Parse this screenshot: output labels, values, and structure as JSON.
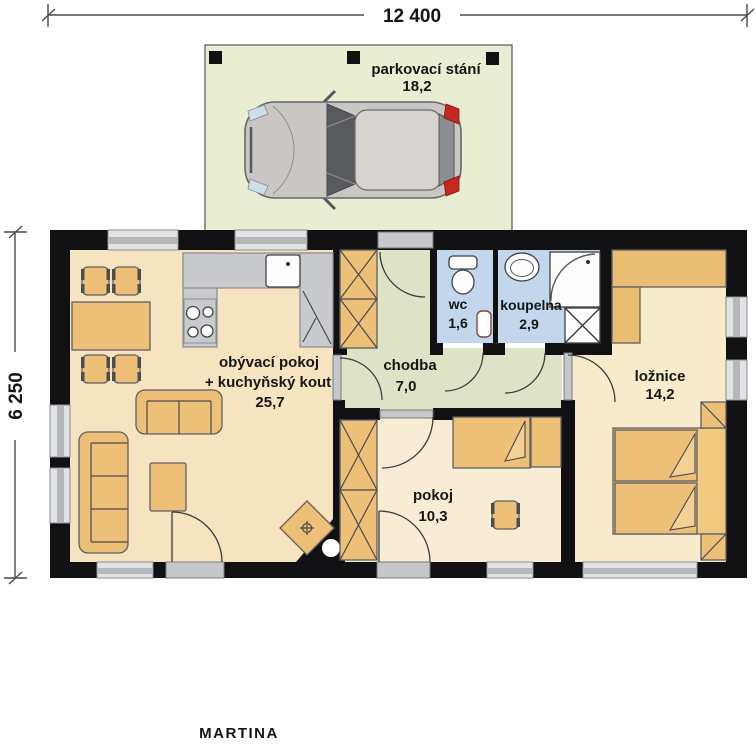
{
  "plan": {
    "title": "MARTINA",
    "dimension_width": "12 400",
    "dimension_height": "6 250"
  },
  "rooms": {
    "parking": {
      "name": "parkovací stání",
      "area": "18,2"
    },
    "living": {
      "name_line1": "obývací pokoj",
      "name_line2": "+ kuchyňský kout",
      "area": "25,7"
    },
    "hall": {
      "name": "chodba",
      "area": "7,0"
    },
    "wc": {
      "name": "wc",
      "area": "1,6"
    },
    "bathroom": {
      "name": "koupelna",
      "area": "2,9"
    },
    "bedroom": {
      "name": "ložnice",
      "area": "14,2"
    },
    "kids_room": {
      "name": "pokoj",
      "area": "10,3"
    }
  },
  "palette": {
    "wall": "#111114",
    "living_floor": "#f6e4c0",
    "room_floor": "#f8ecd4",
    "hall_floor": "#dde3c4",
    "bath_floor": "#c2d6ec",
    "parking_floor": "#e9eed3",
    "furniture_orange": "#edbf77",
    "counter_gray": "#c9cacd",
    "car_body": "#c9c6c3",
    "car_taillight_red": "#c4281e"
  },
  "icons": {
    "car": "top-view car",
    "toilet": "wc toilet bowl with tank",
    "washbasin": "oval bathroom sink",
    "shower": "corner shower with glass arc",
    "washing_machine": "square with X cross",
    "stove": "four burner circles",
    "kitchen_sink": "square sink with drain dot",
    "fireplace": "diamond stove with chimney circle",
    "wardrobe": "rectangle with X cross"
  }
}
